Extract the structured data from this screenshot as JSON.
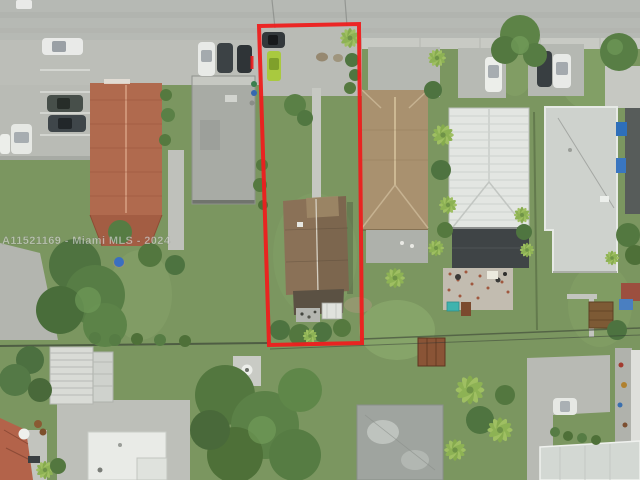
{
  "watermark": {
    "text": "A11521169 - Miami MLS - 2024"
  },
  "palette": {
    "boundary_red": "#ee1d1d",
    "road_gray": "#b6b9b4",
    "pavement_gray": "#bcbeb8",
    "grass_green": "#7b9660",
    "canopy_green": "#55793f",
    "terracotta_roof": "#b06a4e",
    "tan_roof": "#a9916f",
    "subject_roof_brown": "#7c664e",
    "metal_roof_white": "#e3e6e2",
    "charcoal_roof": "#3f4446",
    "flat_roof_gray": "#ced2cd",
    "lime_car_green": "#a9c93f",
    "pool_teal": "#3fb3ae",
    "watermark_color": "rgba(242,242,242,0.55)"
  }
}
